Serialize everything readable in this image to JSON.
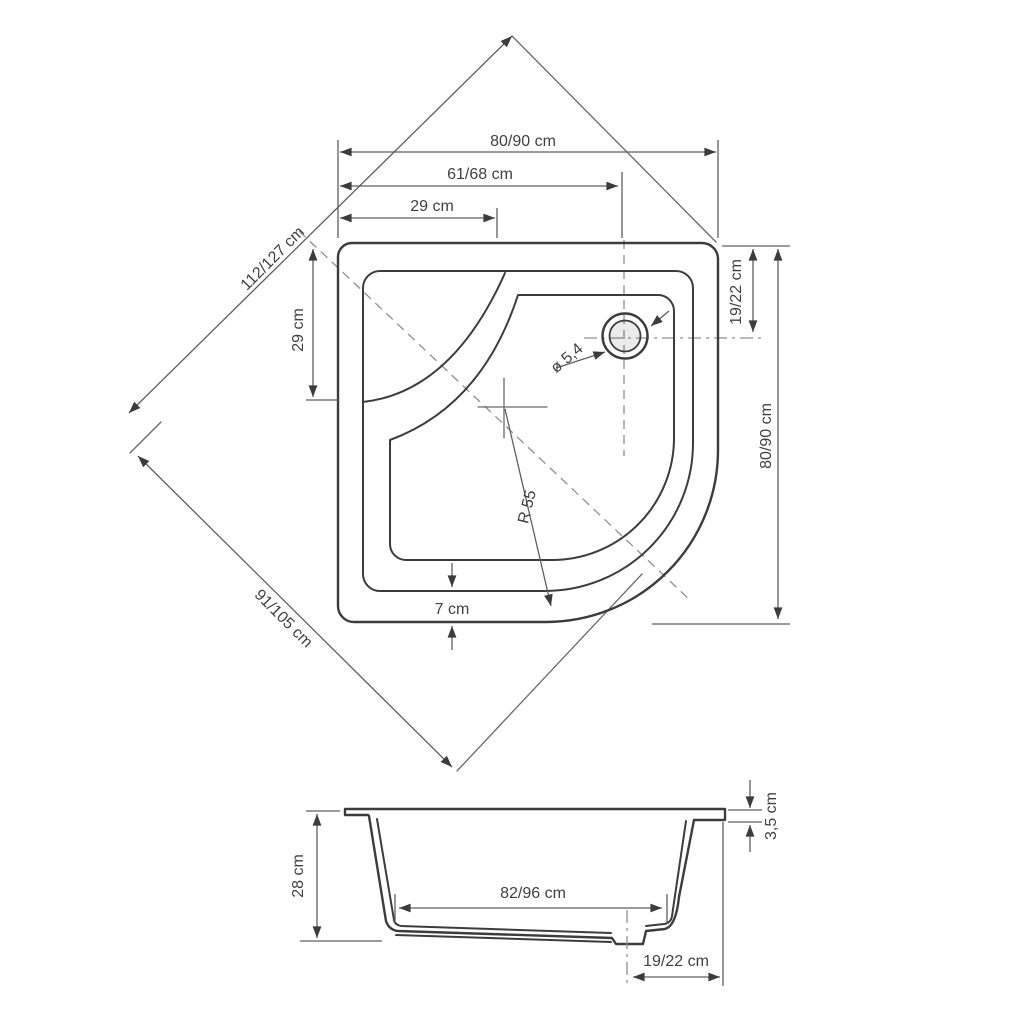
{
  "drawing": {
    "subject": "quadrant-shower-tray-technical-drawing",
    "colors": {
      "background": "#ffffff",
      "outline": "#3c3c3c",
      "dimension_lines": "#5f5f5f",
      "centerlines": "#8f8f8f",
      "text": "#414141",
      "drain_fill": "#e8e8e8"
    },
    "top_view": {
      "width_top": "80/90 cm",
      "drain_offset_x": "61/68 cm",
      "corner_x": "29 cm",
      "diagonal_back": "112/127 cm",
      "corner_y": "29 cm",
      "drain_diameter": "ø 5,4",
      "drain_offset_y": "19/22 cm",
      "width_right": "80/90 cm",
      "front_radius": "R 55",
      "front_edge": "7 cm",
      "diagonal_front": "91/105 cm"
    },
    "side_view": {
      "height": "28 cm",
      "base_width": "82/96 cm",
      "rim_height": "3,5 cm",
      "drain_offset": "19/22 cm"
    }
  }
}
